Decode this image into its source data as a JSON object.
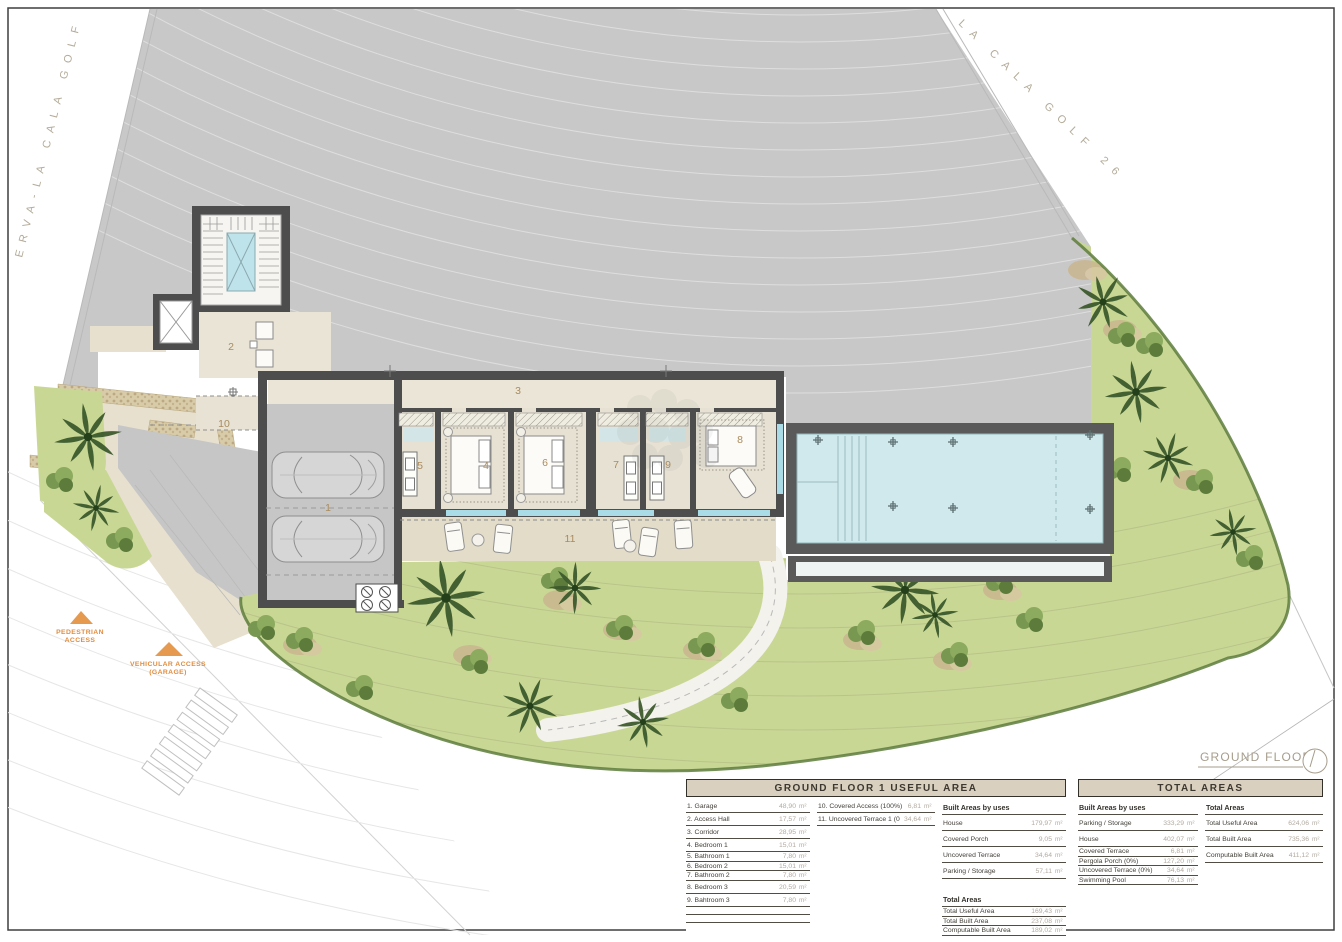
{
  "site": {
    "road_left": "ERVA-LA CALA GOLF",
    "road_right": "LA CALA GOLF 26",
    "plan_label": "GROUND FLOOR 1",
    "pedestrian_access_line1": "PEDESTRIAN",
    "pedestrian_access_line2": "ACCESS",
    "vehicular_access_line1": "VEHICULAR ACCESS",
    "vehicular_access_line2": "(GARAGE)"
  },
  "plan": {
    "room_labels": [
      {
        "text": "1",
        "x": 328,
        "y": 511
      },
      {
        "text": "2",
        "x": 231,
        "y": 350
      },
      {
        "text": "3",
        "x": 518,
        "y": 394
      },
      {
        "text": "4",
        "x": 486,
        "y": 469
      },
      {
        "text": "5",
        "x": 420,
        "y": 469
      },
      {
        "text": "6",
        "x": 545,
        "y": 466
      },
      {
        "text": "7",
        "x": 616,
        "y": 468
      },
      {
        "text": "8",
        "x": 740,
        "y": 443
      },
      {
        "text": "9",
        "x": 668,
        "y": 468
      },
      {
        "text": "10",
        "x": 224,
        "y": 427
      },
      {
        "text": "11",
        "x": 570,
        "y": 542
      }
    ]
  },
  "colors": {
    "accent_orange": "#e08c3e",
    "pool_water": "#cfe9ec",
    "grass": "#c9d795",
    "plot_gray": "#c8c8c8",
    "wall": "#4d4d4d",
    "table_header_bg": "#d9d0bf"
  },
  "tables": {
    "unit": "m²",
    "ground_floor": {
      "title": "GROUND FLOOR 1 USEFUL AREA",
      "built_title": "Built Areas by uses",
      "totals_title": "Total Areas",
      "rooms": [
        {
          "label": "1. Garage",
          "value": "48,90"
        },
        {
          "label": "2. Access Hall",
          "value": "17,57"
        },
        {
          "label": "3. Corridor",
          "value": "28,95"
        },
        {
          "label": "4. Bedroom 1",
          "value": "15,01"
        },
        {
          "label": "5. Bathroom 1",
          "value": "7,80",
          "c": 1
        },
        {
          "label": "6. Bedroom 2",
          "value": "15,01",
          "c": 1
        },
        {
          "label": "7. Bathroom 2",
          "value": "7,80",
          "c": 1
        },
        {
          "label": "8. Bedroom 3",
          "value": "20,59"
        },
        {
          "label": "9. Bahtroom 3",
          "value": "7,80"
        },
        {
          "label": "",
          "value": ""
        },
        {
          "label": "",
          "value": ""
        }
      ],
      "extras": [
        {
          "label": "10. Covered Access (100%)",
          "value": "6,81"
        },
        {
          "label": "11. Uncovered Terrace 1 (0%)",
          "value": "34,64"
        }
      ],
      "built_areas": [
        {
          "label": "House",
          "value": "179,97",
          "t": 1
        },
        {
          "label": "Covered Porch",
          "value": "9,05",
          "t": 1
        },
        {
          "label": "Uncovered Terrace",
          "value": "34,64",
          "t": 1
        },
        {
          "label": "Parking / Storage",
          "value": "57,11",
          "t": 1
        }
      ],
      "totals": [
        {
          "label": "Total Useful Area",
          "value": "169,43",
          "c": 1
        },
        {
          "label": "Total Built Area",
          "value": "237,08",
          "c": 1
        },
        {
          "label": "Computable Built Area",
          "value": "189,02",
          "c": 1
        }
      ]
    },
    "total_areas": {
      "title": "TOTAL AREAS",
      "built_title": "Built Areas by uses",
      "totals_title": "Total Areas",
      "built_areas": [
        {
          "label": "Parking / Storage",
          "value": "333,29",
          "t": 1
        },
        {
          "label": "House",
          "value": "402,07",
          "t": 1
        },
        {
          "label": "Covered Terrace",
          "value": "6,81",
          "c": 1
        },
        {
          "label": "Pergola Porch (0%)",
          "value": "127,20",
          "c": 1
        },
        {
          "label": "Uncovered Terrace (0%)",
          "value": "34,64",
          "c": 1
        },
        {
          "label": "Swimming Pool",
          "value": "76,13",
          "c": 1
        }
      ],
      "totals": [
        {
          "label": "Total Useful Area",
          "value": "624,06",
          "t": 1
        },
        {
          "label": "Total Built Area",
          "value": "735,36",
          "t": 1
        },
        {
          "label": "Computable Built Area",
          "value": "411,12",
          "t": 1
        }
      ]
    }
  }
}
